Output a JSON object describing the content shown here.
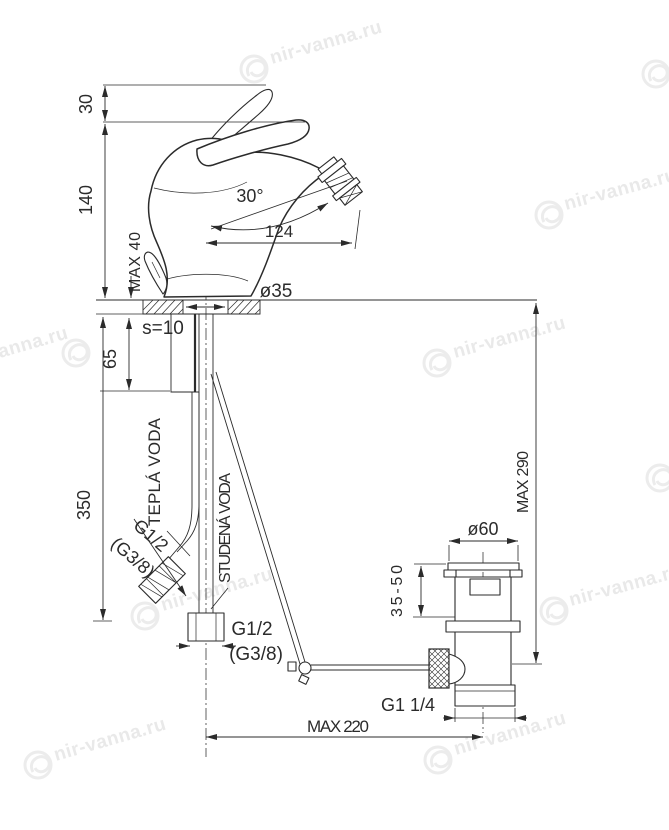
{
  "watermark": {
    "text": "nir-vanna.ru"
  },
  "drawing": {
    "dimensions": {
      "handle_rise": "30",
      "total_height": "140",
      "deck_thickness_max": "MAX 40",
      "swivel_angle": "30°",
      "spout_reach": "124",
      "base_diameter": "ø35",
      "plate_thickness": "s=10",
      "shank_length": "65",
      "supply_length": "350",
      "height_max": "MAX 290",
      "waste_flange_diameter": "ø60",
      "waste_range": "35-50",
      "waste_thread": "G1 1/4",
      "reach_max": "MAX 220"
    },
    "labels": {
      "hot_water": "TEPLÁ VODA",
      "cold_water": "STUDENÁ VODA",
      "hot_thread": "G1/2",
      "hot_thread_alt": "(G3/8)",
      "supply_thread": "G1/2",
      "supply_thread_alt": "(G3/8)"
    }
  }
}
